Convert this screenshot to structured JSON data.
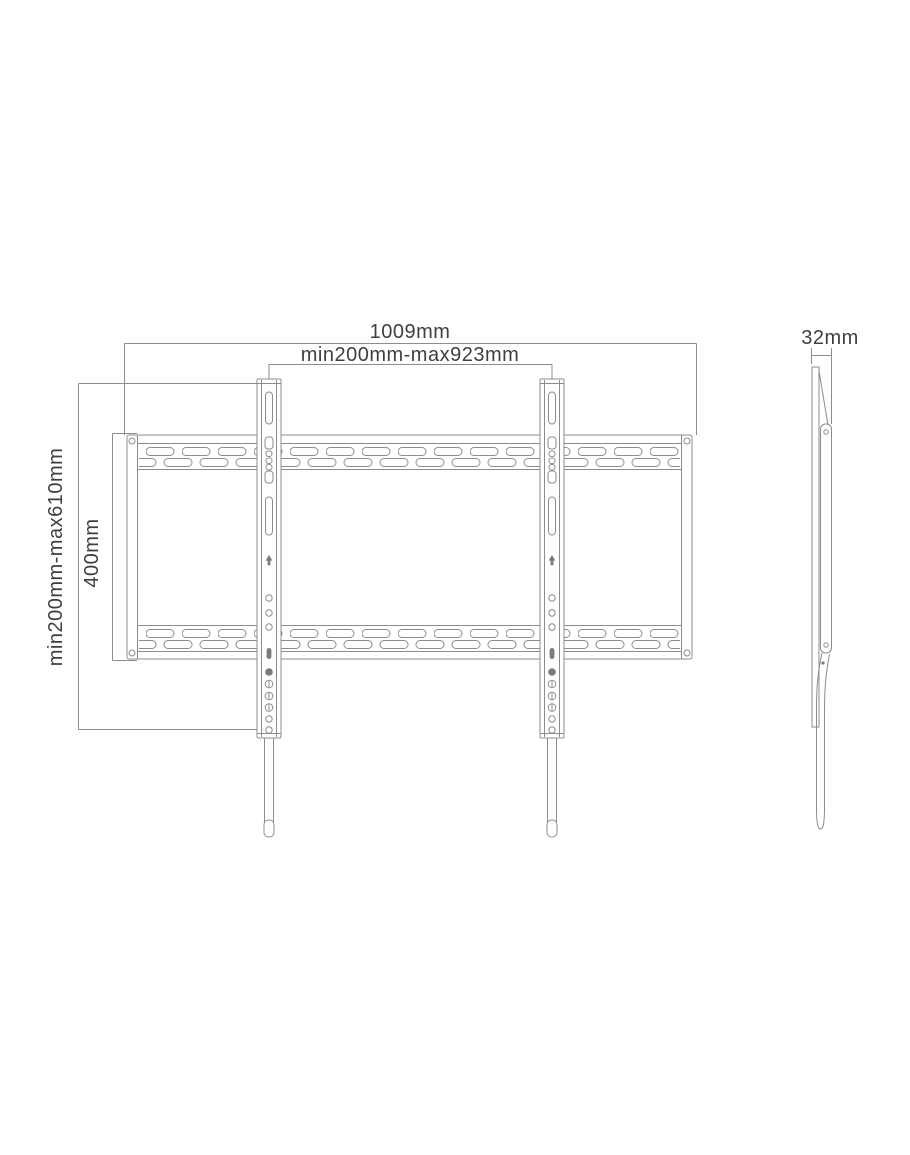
{
  "drawing": {
    "type": "technical-dimension-drawing",
    "subject": "flat TV wall mount bracket, front view and side view",
    "colors": {
      "background": "#ffffff",
      "line": "#8c8c8c",
      "text": "#3f3f3f"
    },
    "dimensions": {
      "total_width": "1009mm",
      "hole_pattern_width_range": "min200mm-max923mm",
      "wall_plate_height": "400mm",
      "hole_pattern_height_range": "min200mm-max610mm",
      "profile_depth": "32mm"
    }
  }
}
